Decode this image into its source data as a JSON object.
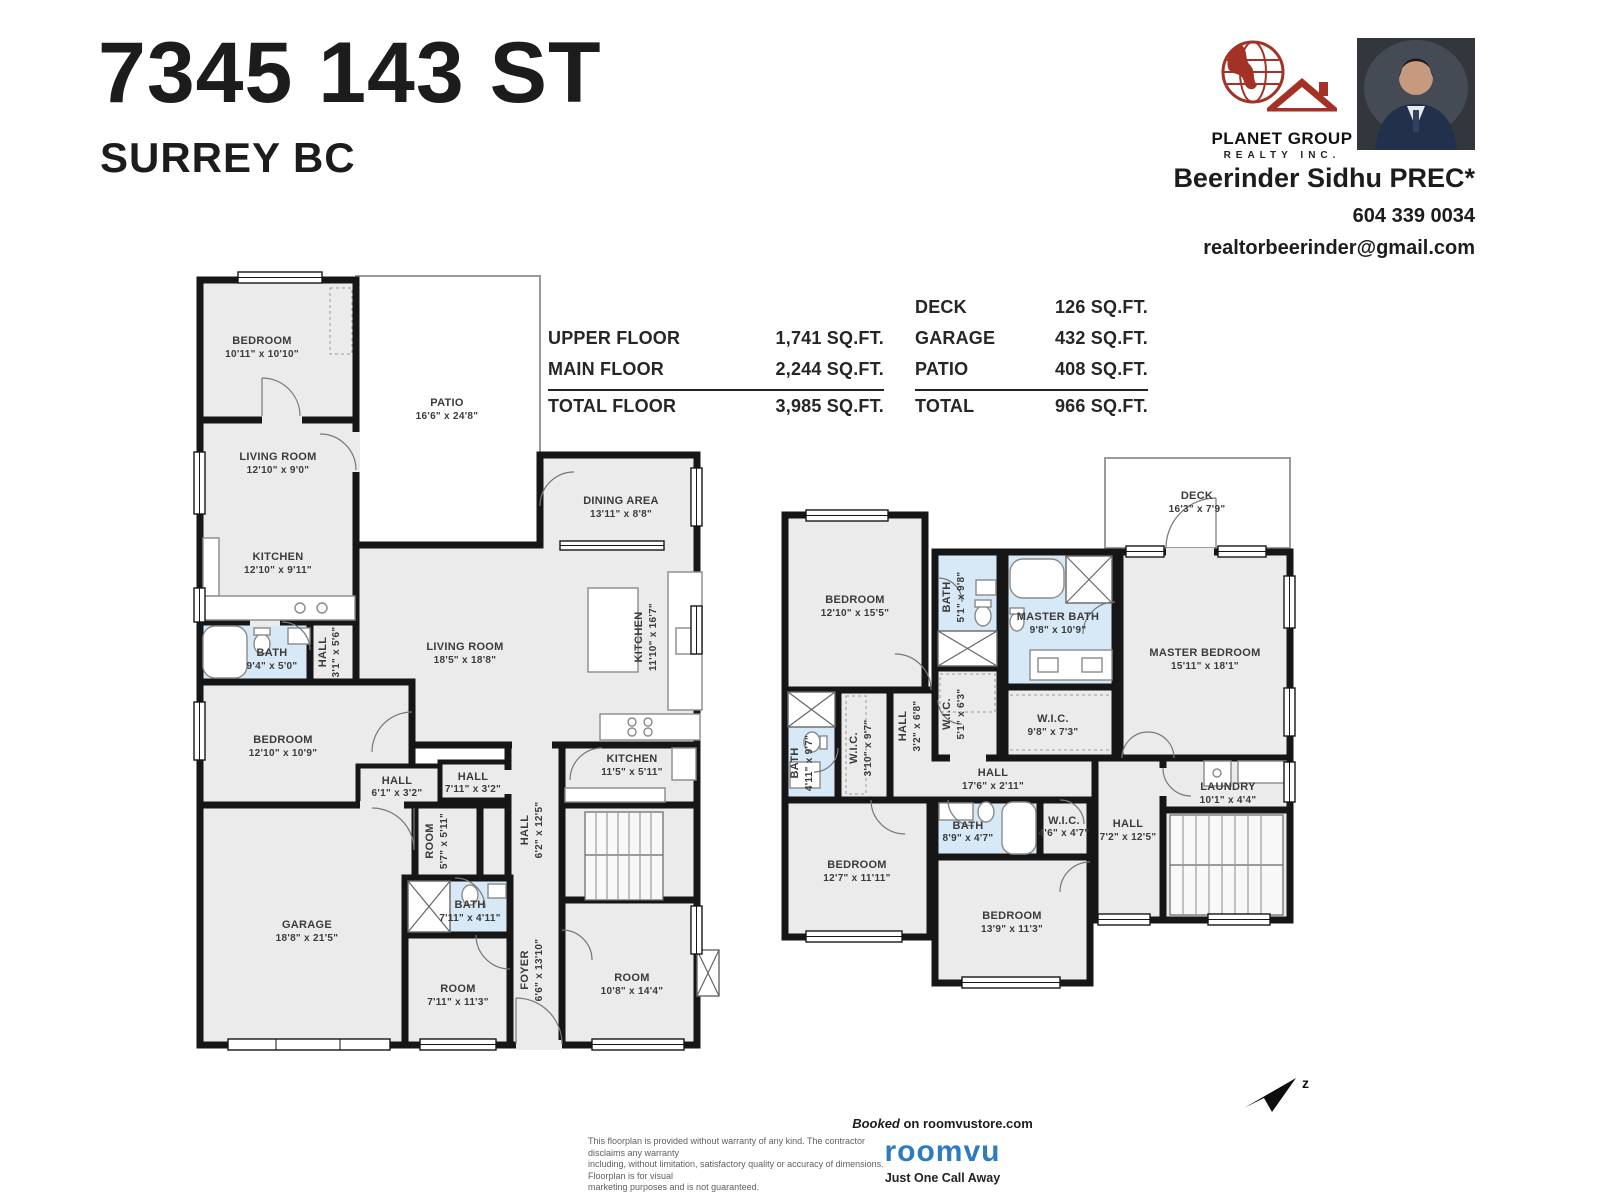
{
  "header": {
    "address": "7345 143 ST",
    "city": "SURREY BC",
    "brokerage_line1": "PLANET GROUP",
    "brokerage_line2": "REALTY INC.",
    "agent_name": "Beerinder Sidhu PREC*",
    "agent_phone": "604 339 0034",
    "agent_email": "realtorbeerinder@gmail.com"
  },
  "area_table": {
    "left_rows": [
      {
        "label": "UPPER FLOOR",
        "value": "1,741 SQ.FT."
      },
      {
        "label": "MAIN FLOOR",
        "value": "2,244 SQ.FT."
      }
    ],
    "left_total": {
      "label": "TOTAL FLOOR",
      "value": "3,985 SQ.FT."
    },
    "right_rows": [
      {
        "label": "DECK",
        "value": "126 SQ.FT."
      },
      {
        "label": "GARAGE",
        "value": "432 SQ.FT."
      },
      {
        "label": "PATIO",
        "value": "408 SQ.FT."
      }
    ],
    "right_total": {
      "label": "TOTAL",
      "value": "966 SQ.FT."
    }
  },
  "main_floor": {
    "rooms": {
      "bedroom_tl": {
        "name": "BEDROOM",
        "dims": "10'11\" x 10'10\""
      },
      "patio": {
        "name": "PATIO",
        "dims": "16'6\" x 24'8\""
      },
      "living_small": {
        "name": "LIVING ROOM",
        "dims": "12'10\" x 9'0\""
      },
      "kitchen_small": {
        "name": "KITCHEN",
        "dims": "12'10\" x 9'11\""
      },
      "bath_small": {
        "name": "BATH",
        "dims": "9'4\" x 5'0\""
      },
      "hall_a": {
        "name": "HALL",
        "dims": "3'1\" x 5'6\""
      },
      "dining": {
        "name": "DINING AREA",
        "dims": "13'11\" x 8'8\""
      },
      "living_main": {
        "name": "LIVING ROOM",
        "dims": "18'5\" x 18'8\""
      },
      "kitchen_main": {
        "name": "KITCHEN",
        "dims": "11'10\" x 16'7\""
      },
      "bedroom_mid": {
        "name": "BEDROOM",
        "dims": "12'10\" x 10'9\""
      },
      "hall_b": {
        "name": "HALL",
        "dims": "6'1\" x 3'2\""
      },
      "hall_c": {
        "name": "HALL",
        "dims": "7'11\" x 3'2\""
      },
      "kitchen_spice": {
        "name": "KITCHEN",
        "dims": "11'5\" x 5'11\""
      },
      "room_small": {
        "name": "ROOM",
        "dims": "5'7\" x 5'11\""
      },
      "hall_d": {
        "name": "HALL",
        "dims": "6'2\" x 12'5\""
      },
      "bath_main": {
        "name": "BATH",
        "dims": "7'11\" x 4'11\""
      },
      "garage": {
        "name": "GARAGE",
        "dims": "18'8\" x 21'5\""
      },
      "room_bl": {
        "name": "ROOM",
        "dims": "7'11\" x 11'3\""
      },
      "foyer": {
        "name": "FOYER",
        "dims": "6'6\" x 13'10\""
      },
      "room_br": {
        "name": "ROOM",
        "dims": "10'8\" x 14'4\""
      }
    }
  },
  "upper_floor": {
    "rooms": {
      "deck": {
        "name": "DECK",
        "dims": "16'3\" x 7'9\""
      },
      "bedroom_a": {
        "name": "BEDROOM",
        "dims": "12'10\" x 15'5\""
      },
      "bath_a": {
        "name": "BATH",
        "dims": "5'1\" x 9'8\""
      },
      "master_bath": {
        "name": "MASTER BATH",
        "dims": "9'8\" x 10'9\""
      },
      "master_bedroom": {
        "name": "MASTER BEDROOM",
        "dims": "15'11\" x 18'1\""
      },
      "wic_a": {
        "name": "W.I.C.",
        "dims": "5'1\" x 6'3\""
      },
      "hall_v": {
        "name": "HALL",
        "dims": "3'2\" x 6'8\""
      },
      "wic_master": {
        "name": "W.I.C.",
        "dims": "9'8\" x 7'3\""
      },
      "bath_b": {
        "name": "BATH",
        "dims": "4'11\" x 9'7\""
      },
      "wic_b": {
        "name": "W.I.C.",
        "dims": "3'10\" x 9'7\""
      },
      "hall_main": {
        "name": "HALL",
        "dims": "17'6\" x 2'11\""
      },
      "laundry": {
        "name": "LAUNDRY",
        "dims": "10'1\" x 4'4\""
      },
      "bath_c": {
        "name": "BATH",
        "dims": "8'9\" x 4'7\""
      },
      "wic_c": {
        "name": "W.I.C.",
        "dims": "4'6\" x 4'7\""
      },
      "hall_b2": {
        "name": "HALL",
        "dims": "7'2\" x 12'5\""
      },
      "bedroom_bl": {
        "name": "BEDROOM",
        "dims": "12'7\" x 11'11\""
      },
      "bedroom_bm": {
        "name": "BEDROOM",
        "dims": "13'9\" x 11'3\""
      }
    }
  },
  "footer": {
    "disclaimer_line1": "This floorplan is provided without  warranty of any kind. The contractor disclaims any warranty",
    "disclaimer_line2": "including, without limitation, satisfactory quality or accuracy of dimensions. Floorplan is for visual",
    "disclaimer_line3": "marketing purposes and is not guaranteed.",
    "booked_prefix": "Booked",
    "booked_rest": " on roomvustore.com",
    "roomvu_wordmark": "roomvu",
    "roomvu_tagline": "Just  One Call Away"
  },
  "compass": {
    "letter": "z"
  },
  "colors": {
    "wall": "#161616",
    "floor": "#ebebeb",
    "bath_blue": "#d7e9f6",
    "brand_red": "#a33126",
    "roomvu_blue": "#2e7cc0"
  }
}
